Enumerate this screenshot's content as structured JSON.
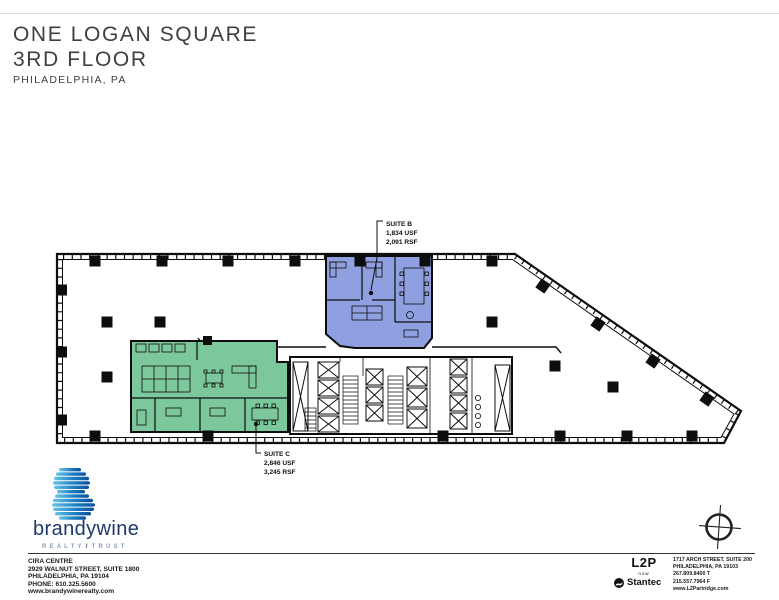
{
  "header": {
    "building": "ONE LOGAN SQUARE",
    "floor": "3RD FLOOR",
    "city": "PHILADELPHIA, PA"
  },
  "plan": {
    "suite_b": {
      "name": "SUITE B",
      "usf": "1,834 USF",
      "rsf": "2,091 RSF",
      "fill": "#8fa0e0"
    },
    "suite_c": {
      "name": "SUITE C",
      "usf": "2,846 USF",
      "rsf": "3,245 RSF",
      "fill": "#7cc79b"
    }
  },
  "footer": {
    "brandywine": {
      "name": "brandywine",
      "tagline_left": "REALTY",
      "tagline_right": "TRUST",
      "lines": [
        "CIRA CENTRE",
        "2929 WALNUT STREET, SUITE 1800",
        "PHILADELPHIA, PA 19104",
        "PHONE: 610.325.5600",
        "www.brandywinerealty.com"
      ],
      "brand_navy": "#1c3a6b",
      "brand_cyan": "#2fa8dc",
      "brand_green": "#76b043"
    },
    "architect": {
      "logo": "L2P",
      "logo_sub": "now",
      "partner": "Stantec",
      "lines": [
        "1717 ARCH STREET, SUITE 200",
        "PHILADELPHIA, PA 19103",
        "267.809.8400 T",
        "215.557.7964 F",
        "www.L2Partridge.com"
      ]
    }
  },
  "icons": {
    "compass": "north-compass",
    "stantec_logo": "stantec-circle"
  }
}
